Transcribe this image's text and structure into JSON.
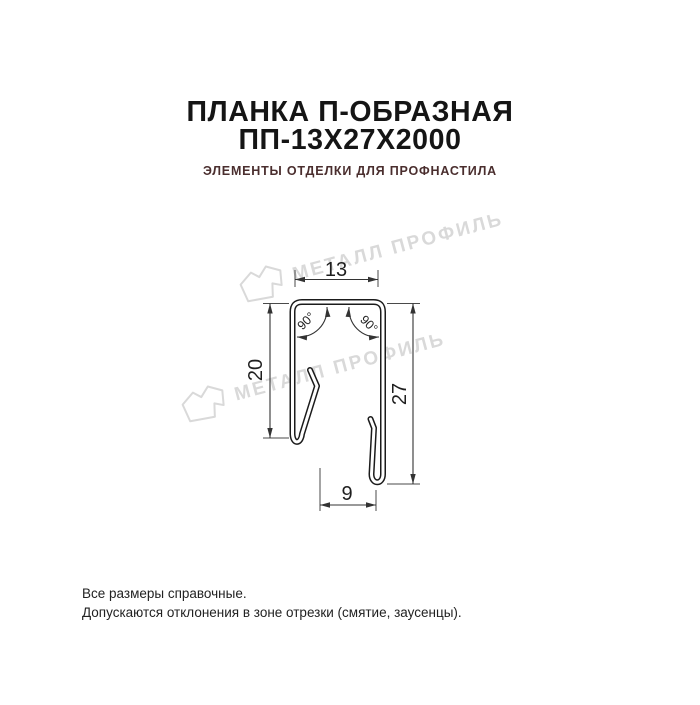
{
  "header": {
    "title_line1": "ПЛАНКА П-ОБРАЗНАЯ",
    "title_line2": "ПП-13Х27Х2000",
    "subtitle": "ЭЛЕМЕНТЫ ОТДЕЛКИ ДЛЯ ПРОФНАСТИЛА",
    "subtitle_color": "#4a2e2e"
  },
  "watermark": {
    "text": "МЕТАЛЛ ПРОФИЛЬ",
    "color": "#d9d9d9"
  },
  "drawing": {
    "type": "profile-cross-section",
    "line_color": "#1b1b1b",
    "dim_color": "#333333",
    "dimensions": {
      "width_top": "13",
      "left_leg": "20",
      "right_leg": "27",
      "bottom_gap": "9",
      "angle_left": "90°",
      "angle_right": "90°"
    }
  },
  "footer": {
    "line1": "Все размеры справочные.",
    "line2": "Допускаются отклонения в зоне отрезки (смятие, заусенцы)."
  }
}
